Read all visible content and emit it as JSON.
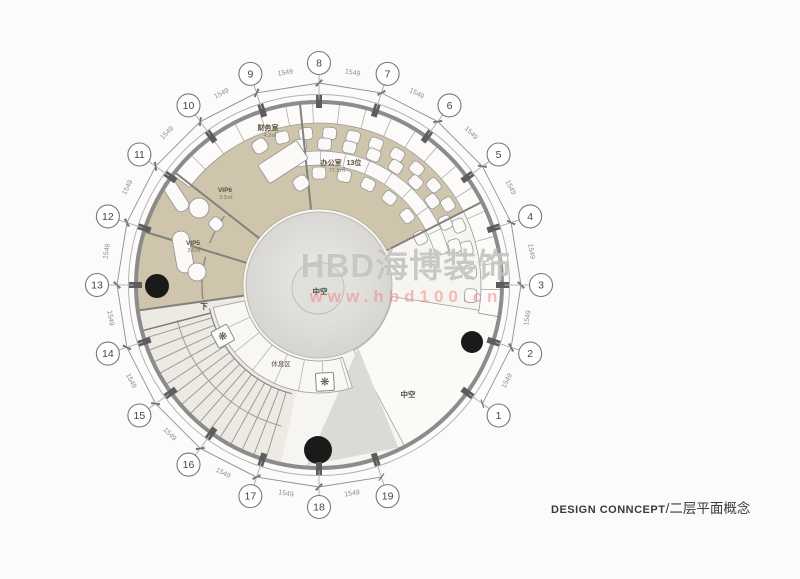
{
  "watermark": {
    "brand": "HBD海博装饰",
    "url": "www.hbd100.cn"
  },
  "title_block": {
    "design_label": "DESIGN CONNCEPT",
    "separator": "/",
    "plan_label": "二层平面概念"
  },
  "grid": {
    "bubble_numbers": [
      "1",
      "2",
      "3",
      "4",
      "5",
      "6",
      "7",
      "8",
      "9",
      "10",
      "11",
      "12",
      "13",
      "14",
      "15",
      "16",
      "17",
      "18",
      "19"
    ],
    "dimension_label": "1549"
  },
  "rooms": {
    "finance": {
      "name": "财务室",
      "area": "4.2㎡"
    },
    "office": {
      "name": "办公室",
      "seats": "13位",
      "area": "77.5㎡"
    },
    "vip6": {
      "name": "VIP6",
      "area": "3.5㎡"
    },
    "vip5": {
      "name": "VIP5",
      "area": "3.5㎡"
    },
    "rest": {
      "name": "休息区"
    },
    "atrium_center": {
      "name": "中空"
    },
    "atrium_side": {
      "name": "中空"
    },
    "stairs_down": {
      "name": "下"
    }
  },
  "icons": {
    "plant": "❋"
  },
  "colors": {
    "room_tan": "#cfc5ac",
    "floor_light": "#f6f5f1",
    "stair_cream": "#eceae2",
    "void_white": "#fbfaf7",
    "wedge_gray": "#dcdad4",
    "center_gray": "#d6d5d2",
    "center_inner": "#e0dfdc",
    "wall_gray": "#8c8c8c",
    "furniture_white": "#fbfaf8",
    "marker_black": "#1a1a1a"
  }
}
